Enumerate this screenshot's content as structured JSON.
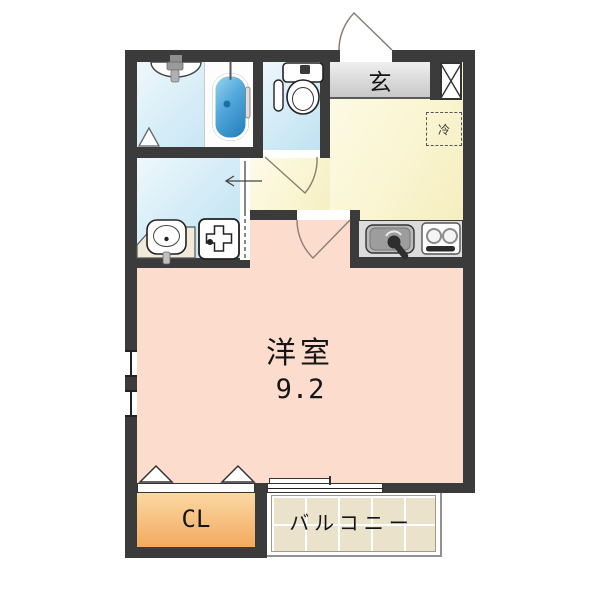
{
  "plan": {
    "rooms": {
      "western_room": {
        "name": "洋室",
        "area": "9.2"
      },
      "entrance": {
        "name": "玄"
      },
      "closet": {
        "name": "CL"
      },
      "balcony": {
        "name": "バルコニー"
      },
      "refrigerator_space": {
        "name": "冷"
      }
    },
    "fixtures": [
      {
        "icon": "bathtub-icon"
      },
      {
        "icon": "bathroom-sink-icon"
      },
      {
        "icon": "toilet-icon"
      },
      {
        "icon": "vanity-sink-icon"
      },
      {
        "icon": "washing-machine-pan-icon"
      },
      {
        "icon": "kitchen-sink-icon"
      },
      {
        "icon": "gas-stove-icon"
      },
      {
        "icon": "pipe-shaft-x-icon"
      },
      {
        "icon": "entrance-door-arc-icon"
      },
      {
        "icon": "toilet-door-arc-icon"
      },
      {
        "icon": "room-door-arc-icon"
      },
      {
        "icon": "sliding-door-arrow-icon"
      },
      {
        "icon": "closet-folding-door-icon"
      },
      {
        "icon": "balcony-sliding-window-icon"
      }
    ],
    "colors": {
      "wall": "#3b3b3b",
      "wet_room_floor": "#cfe8f4",
      "kitchen_floor": "#faf5d2",
      "main_room_floor": "#fbdacc",
      "closet_floor": "#f5b46a",
      "entrance_floor": "#d9d9d9",
      "balcony_tile": "#eae2cb",
      "bathtub_blue": "#4a9fd4"
    }
  }
}
